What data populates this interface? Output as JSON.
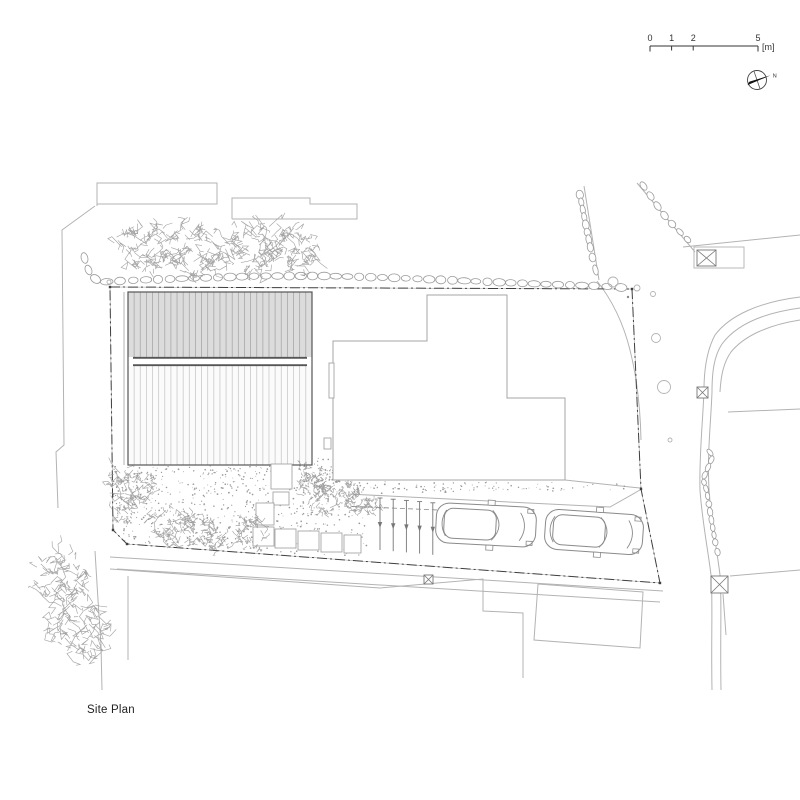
{
  "title": "Site Plan",
  "scale_bar": {
    "x": 650,
    "y": 46,
    "len": 108,
    "tick_fracs": [
      0,
      0.2,
      0.4,
      1
    ],
    "labels": [
      "0",
      "1",
      "2",
      "5"
    ],
    "unit": "[m]"
  },
  "north": {
    "cx": 757,
    "cy": 80,
    "r": 9.5,
    "label": "N"
  },
  "colors": {
    "context": "#b3b3b3",
    "site_line": "#8c8c8c",
    "tree": "#9b9b9b",
    "stone": "#9b9b9b",
    "car": "#8a8a8a",
    "boundary": "#3f3f3f",
    "text": "#222",
    "stipple": "#9a9a9a",
    "bldg_outline": "#555555",
    "top_fill": "#dcdcdc",
    "top_stripe": "#a8a8a8",
    "bottom_fill": "#fbfbfb",
    "bottom_stripe": "#c9c9c9",
    "neighbor": "#a5a5a5",
    "post": "#777777"
  },
  "site": {
    "main_building": {
      "x": 128,
      "y": 292,
      "w": 184,
      "h": 173,
      "ridge_y1": 357,
      "ridge_y2": 366,
      "ridge_inset": 5,
      "stripe_step": 6.13
    },
    "neighbor_building": {
      "points": [
        [
          333,
          480
        ],
        [
          333,
          341
        ],
        [
          427,
          341
        ],
        [
          427,
          295
        ],
        [
          507,
          295
        ],
        [
          507,
          398
        ],
        [
          565,
          398
        ],
        [
          565,
          480
        ]
      ],
      "wall_rects": [
        [
          329,
          363,
          5,
          35
        ],
        [
          324,
          438,
          7,
          11
        ]
      ]
    },
    "context_polylines": [
      [
        [
          95,
          206
        ],
        [
          62,
          230
        ],
        [
          64,
          445
        ],
        [
          56,
          452
        ],
        [
          58,
          508
        ]
      ],
      [
        [
          97,
          206
        ],
        [
          97,
          183
        ],
        [
          217,
          183
        ],
        [
          217,
          204
        ],
        [
          97,
          204
        ]
      ],
      [
        [
          232,
          219
        ],
        [
          232,
          198
        ],
        [
          310,
          198
        ],
        [
          310,
          204
        ],
        [
          357,
          204
        ],
        [
          357,
          219
        ],
        [
          232,
          219
        ]
      ],
      [
        [
          110,
          569
        ],
        [
          380,
          588
        ],
        [
          483,
          579
        ],
        [
          483,
          611
        ],
        [
          523,
          613
        ],
        [
          523,
          678
        ]
      ],
      [
        [
          128,
          576
        ],
        [
          128,
          660
        ]
      ],
      [
        [
          538,
          584
        ],
        [
          643,
          592
        ],
        [
          640,
          648
        ],
        [
          534,
          640
        ],
        [
          538,
          584
        ]
      ],
      [
        [
          584,
          186
        ],
        [
          599,
          280
        ]
      ],
      [
        [
          637,
          183
        ],
        [
          690,
          246
        ],
        [
          695,
          252
        ]
      ],
      [
        [
          683,
          247
        ],
        [
          800,
          235
        ]
      ],
      [
        [
          728,
          412
        ],
        [
          800,
          409
        ]
      ],
      [
        [
          730,
          576
        ],
        [
          800,
          570
        ]
      ],
      [
        [
          95,
          551
        ],
        [
          98,
          600
        ],
        [
          101,
          645
        ],
        [
          102,
          690
        ]
      ],
      [
        [
          110,
          557
        ],
        [
          663,
          591
        ]
      ],
      [
        [
          117,
          569
        ],
        [
          660,
          602
        ]
      ],
      [
        [
          565,
          480
        ],
        [
          640,
          488
        ]
      ],
      [
        [
          348,
          494
        ],
        [
          610,
          507
        ],
        [
          640,
          490
        ]
      ],
      [
        [
          348,
          455
        ],
        [
          348,
          488
        ]
      ],
      [
        [
          124,
          292
        ],
        [
          124,
          465
        ]
      ],
      [
        [
          723,
          594
        ],
        [
          726,
          635
        ]
      ]
    ],
    "context_curves": [
      "M597,281 Q620,310 630,350 T641,440",
      "M800,297 C760,302 730,315 715,335 C707,350 704,370 704,390",
      "M800,308 C763,313 736,325 722,344 C714,356 712,372 712,392",
      "M800,320 C768,325 744,336 731,352 C724,362 721,374 720,392",
      "M704,390 C703,420 699,455 700,490 C702,520 708,550 711,575 C713,600 711,635 712,690",
      "M712,392 C711,420 707,455 709,490 C711,520 717,550 720,575 C722,600 720,635 721,690"
    ],
    "boundary": {
      "pts": [
        [
          110,
          287
        ],
        [
          632,
          289
        ],
        [
          641,
          489
        ],
        [
          660,
          583
        ],
        [
          127,
          544
        ],
        [
          113,
          530
        ]
      ],
      "dash": "10 3 2 3"
    },
    "stone_rows": [
      {
        "pts": [
          [
            83,
            252
          ],
          [
            86,
            264
          ],
          [
            91,
            276
          ],
          [
            100,
            282
          ],
          [
            140,
            280
          ],
          [
            200,
            278
          ],
          [
            260,
            276
          ],
          [
            330,
            276
          ],
          [
            400,
            278
          ],
          [
            470,
            281
          ],
          [
            540,
            284
          ],
          [
            600,
            286
          ],
          [
            628,
            288
          ]
        ],
        "rx": 5.5,
        "ry": 3.4
      },
      {
        "pts": [
          [
            579,
            191
          ],
          [
            582,
            206
          ],
          [
            585,
            221
          ],
          [
            588,
            236
          ],
          [
            591,
            251
          ],
          [
            594,
            264
          ],
          [
            597,
            276
          ]
        ],
        "rx": 4.5,
        "ry": 3.1
      },
      {
        "pts": [
          [
            640,
            181
          ],
          [
            647,
            191
          ],
          [
            654,
            201
          ],
          [
            661,
            211
          ],
          [
            668,
            220
          ],
          [
            676,
            228
          ],
          [
            684,
            236
          ],
          [
            691,
            243
          ]
        ],
        "rx": 4.3,
        "ry": 2.9
      },
      {
        "pts": [
          [
            707,
            449
          ],
          [
            713,
            456
          ],
          [
            703,
            479
          ],
          [
            707,
            492
          ],
          [
            712,
            524
          ],
          [
            716,
            546
          ],
          [
            719,
            558
          ]
        ],
        "rx": 3.8,
        "ry": 2.5
      }
    ],
    "trees": [
      [
        148,
        247,
        27
      ],
      [
        197,
        252,
        29
      ],
      [
        253,
        246,
        27
      ],
      [
        294,
        250,
        24
      ],
      [
        130,
        486,
        22
      ],
      [
        121,
        514,
        11
      ],
      [
        168,
        524,
        20
      ],
      [
        199,
        527,
        17
      ],
      [
        216,
        539,
        13
      ],
      [
        252,
        533,
        17
      ],
      [
        313,
        487,
        14
      ],
      [
        310,
        472,
        11
      ],
      [
        327,
        498,
        15
      ],
      [
        350,
        492,
        10
      ],
      [
        357,
        501,
        12
      ],
      [
        370,
        505,
        10
      ],
      [
        60,
        578,
        27
      ],
      [
        77,
        627,
        30
      ]
    ],
    "cars": [
      {
        "cx": 486,
        "cy": 525,
        "angle": 3,
        "len": 100,
        "wid": 40
      },
      {
        "cx": 594,
        "cy": 532,
        "angle": 4,
        "len": 98,
        "wid": 40
      }
    ],
    "posts": {
      "x0": 380,
      "y0": 498,
      "dx": 13.2,
      "dy": 1.2,
      "len": 52,
      "count": 5
    },
    "dashed_line": [
      [
        344,
        506
      ],
      [
        438,
        510
      ]
    ],
    "pavers": [
      [
        253,
        527,
        21,
        19
      ],
      [
        275,
        529,
        21,
        19
      ],
      [
        298,
        531,
        21,
        19
      ],
      [
        321,
        533,
        21,
        19
      ],
      [
        344,
        535,
        17,
        18
      ],
      [
        273,
        492,
        16,
        13
      ],
      [
        256,
        503,
        18,
        22
      ],
      [
        271,
        464,
        21,
        25
      ]
    ],
    "utility_boxes": [
      {
        "x": 697,
        "y": 250,
        "w": 19,
        "h": 16,
        "outer": [
          694,
          247,
          50,
          21
        ]
      },
      {
        "x": 697,
        "y": 387,
        "w": 11,
        "h": 11
      },
      {
        "x": 711,
        "y": 576,
        "w": 17,
        "h": 17
      },
      {
        "x": 424,
        "y": 575,
        "w": 9,
        "h": 9
      }
    ],
    "circles": [
      [
        613,
        282,
        5
      ],
      [
        637,
        288,
        3
      ],
      [
        653,
        294,
        2.5
      ],
      [
        656,
        338,
        4.5
      ],
      [
        664,
        387,
        6.5
      ],
      [
        670,
        440,
        2
      ],
      [
        109,
        282,
        2
      ]
    ],
    "filled_dots": [
      [
        628,
        297,
        1.2
      ]
    ],
    "stipple_regions": [
      {
        "poly": [
          [
            113,
            466
          ],
          [
            338,
            466
          ],
          [
            338,
            490
          ],
          [
            368,
            523
          ],
          [
            368,
            558
          ],
          [
            127,
            543
          ],
          [
            113,
            528
          ]
        ],
        "n": 650
      },
      {
        "poly": [
          [
            336,
            481
          ],
          [
            630,
            483
          ],
          [
            630,
            490
          ],
          [
            336,
            494
          ]
        ],
        "n": 120
      },
      {
        "poly": [
          [
            314,
            458
          ],
          [
            336,
            458
          ],
          [
            336,
            494
          ],
          [
            314,
            494
          ]
        ],
        "n": 55
      }
    ]
  }
}
